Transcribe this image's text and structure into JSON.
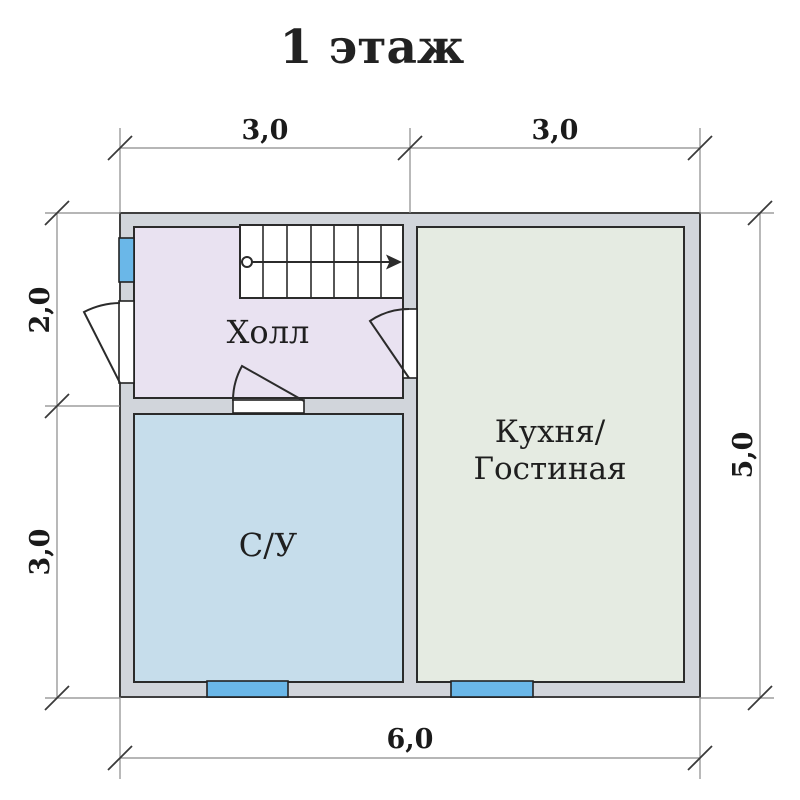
{
  "title": "1 этаж",
  "plan": {
    "rooms": {
      "hall": {
        "label": "Холл"
      },
      "bathroom": {
        "label": "С/У"
      },
      "kitchen": {
        "label_line1": "Кухня/",
        "label_line2": "Гостиная"
      }
    },
    "dimensions": {
      "top": [
        "3,0",
        "3,0"
      ],
      "left": [
        "2,0",
        "3,0"
      ],
      "right": [
        "5,0"
      ],
      "bottom": [
        "6,0"
      ]
    },
    "colors": {
      "wall_fill": "#d1d5db",
      "wall_outline": "#3f3f3f",
      "room_outline": "#2b2b2b",
      "hall_fill": "#e9e2f1",
      "bathroom_fill": "#c6ddeb",
      "kitchen_fill": "#e5ebe2",
      "window_fill": "#6ab7e8",
      "dim_line": "#8a8a8a",
      "tick": "#3a3a3a"
    },
    "features": {
      "stairs_treads": 7,
      "stairs_direction": "up-right",
      "windows_count": 3,
      "doors_count": 3
    }
  }
}
